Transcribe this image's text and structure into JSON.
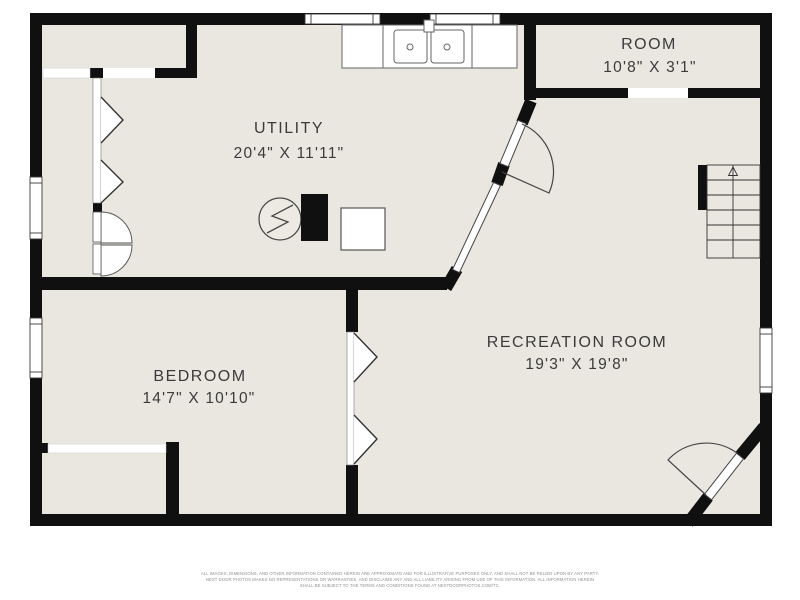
{
  "floorplan": {
    "rooms": [
      {
        "name": "UTILITY",
        "dimensions": "20'4\" X 11'11\""
      },
      {
        "name": "ROOM",
        "dimensions": "10'8\" X 3'1\""
      },
      {
        "name": "BEDROOM",
        "dimensions": "14'7\" X 10'10\""
      },
      {
        "name": "RECREATION ROOM",
        "dimensions": "19'3\" X 19'8\""
      }
    ],
    "colors": {
      "wall": "#101010",
      "floor": "#e9e7e0",
      "label_text": "#3b3b3b",
      "fixture_line": "#4a4a4a",
      "door_line": "#555555",
      "disclaimer_text": "#8f8f8f",
      "background": "#ffffff"
    },
    "icons": {
      "stairs": "stairs with up arrow",
      "water_heater": "circle with lightning bolt",
      "sink": "double kitchen sink"
    }
  },
  "disclaimer": {
    "line1": "ALL IMAGES, DIMENSIONS, AND OTHER INFORMATION CONTAINED HEREIN ARE APPROXIMATE AND FOR ILLUSTRATIVE PURPOSES ONLY, AND SHALL NOT BE RELIED UPON BY ANY PARTY.",
    "line2": "NEXT DOOR PHOTOS MAKES NO REPRESENTATIONS OR WARRANTIES, AND DISCLAIMS ANY AND ALL LIABILITY ARISING FROM USE OF THIS INFORMATION. ALL INFORMATION HEREIN",
    "line3": "SHALL BE SUBJECT TO THE TERMS AND CONDITIONS FOUND AT NEXTDOORPHOTOS.COM/TC."
  }
}
